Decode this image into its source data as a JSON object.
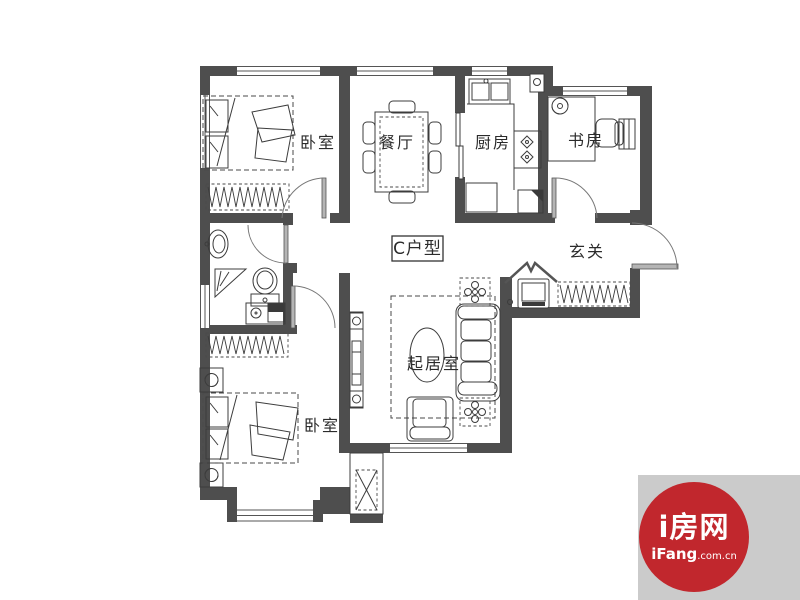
{
  "plan": {
    "unit_type": "C户型",
    "rooms": {
      "bedroom_top": "卧室",
      "dining": "餐厅",
      "kitchen": "厨房",
      "study": "书房",
      "entry": "玄关",
      "living": "起居室",
      "bedroom_bottom": "卧室"
    }
  },
  "watermark": {
    "brand": "i房网",
    "site": "iFang",
    "site_suffix": ".com.cn",
    "badge_bg": "#cbcbcb",
    "circle_color": "#c1272d",
    "text_color": "#ffffff"
  },
  "colors": {
    "wall": "#4e4e4e",
    "line": "#3c3c3c",
    "background": "#ffffff"
  }
}
